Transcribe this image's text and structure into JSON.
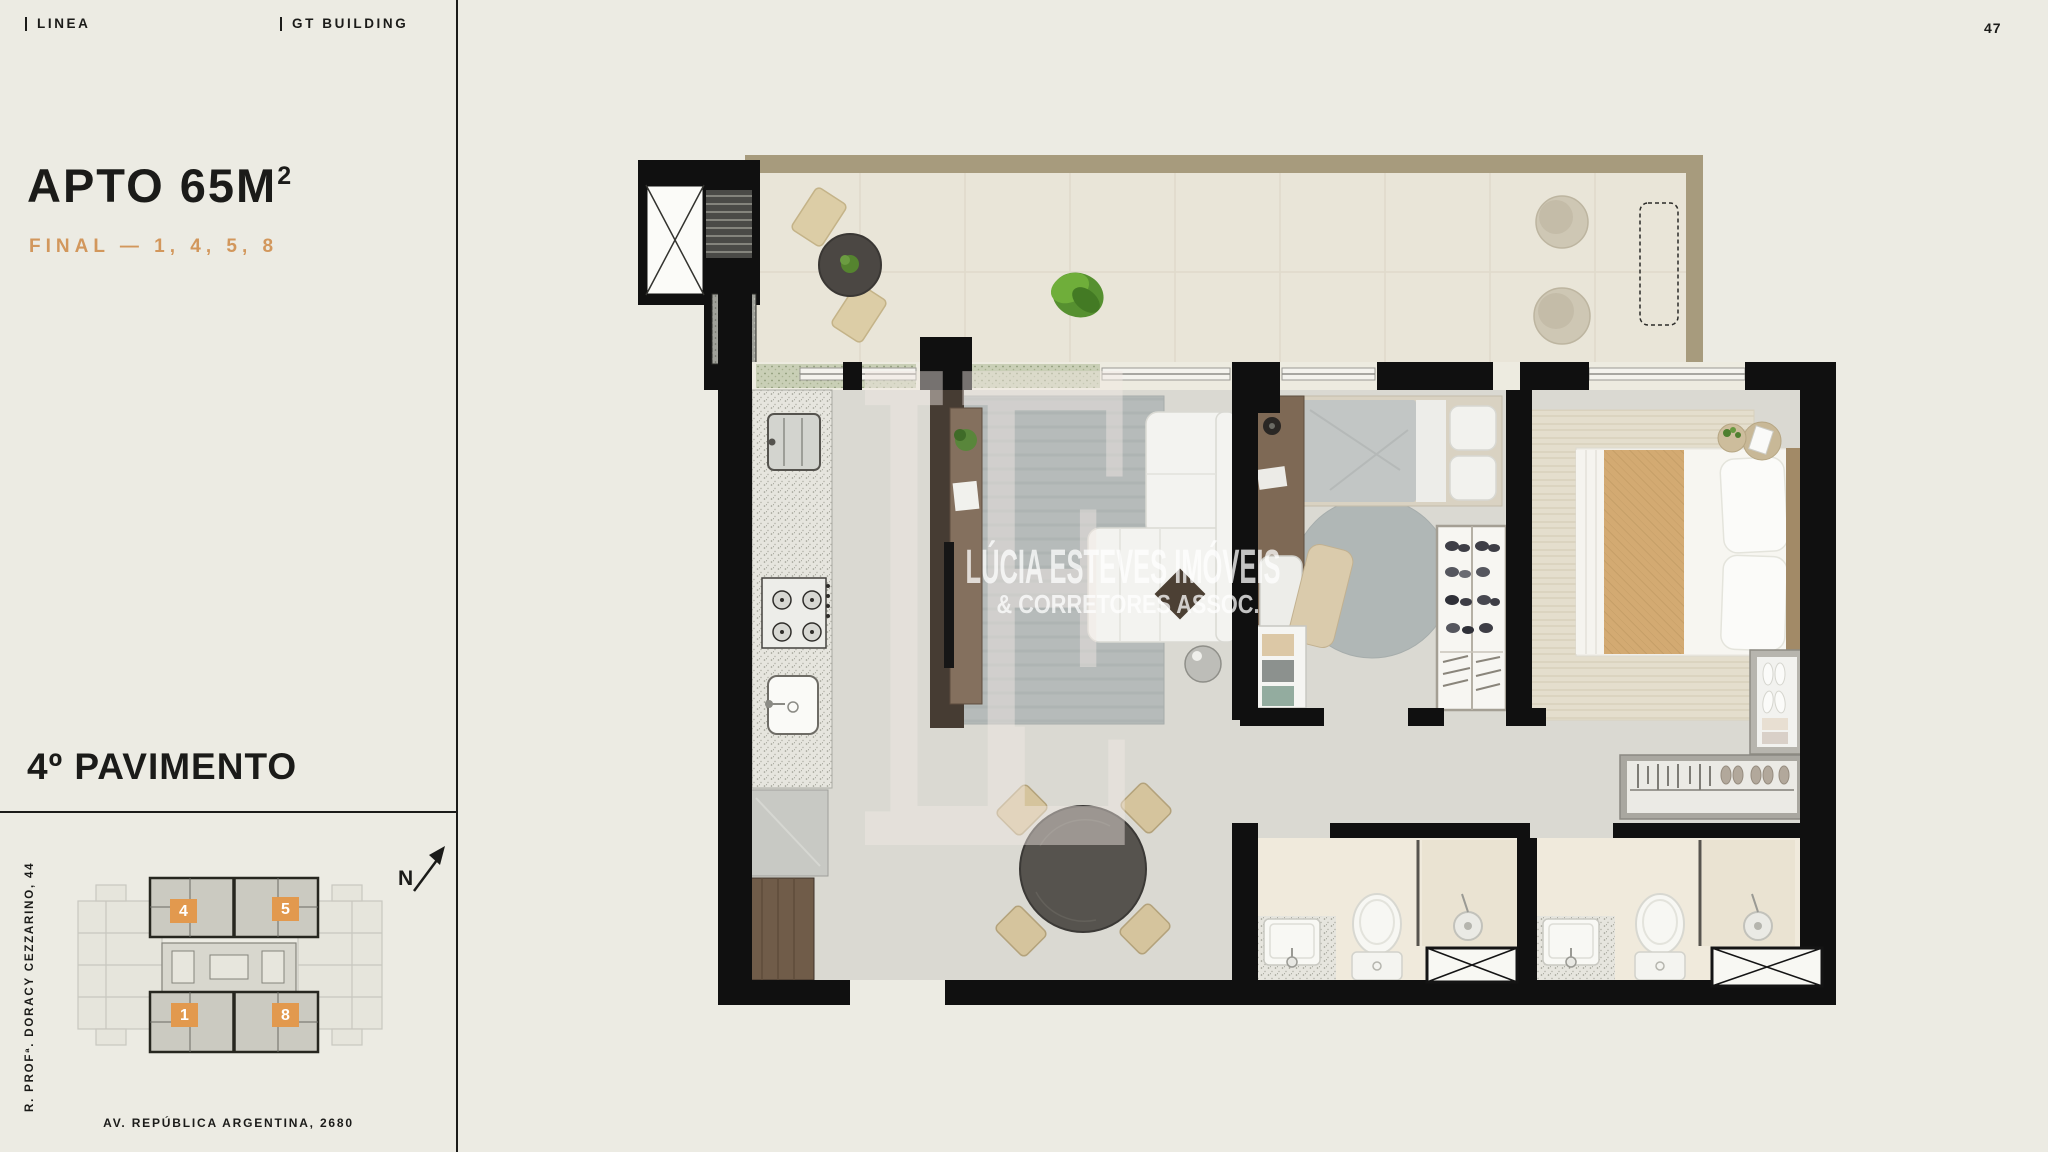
{
  "page": {
    "background": "#ECEBE3",
    "number": "47"
  },
  "header": {
    "brands": [
      {
        "label": "LINEA"
      },
      {
        "label": "GT BUILDING"
      }
    ]
  },
  "sidebar": {
    "title_main": "APTO 65M",
    "title_sup": "2",
    "subtitle": "FINAL — 1, 4, 5, 8",
    "subtitle_color": "#D2975C",
    "floor_label": "4º PAVIMENTO",
    "street_side": "R. PROFª. DORACY CEZZARINO, 44",
    "street_bottom": "AV. REPÚBLICA ARGENTINA, 2680",
    "north_label": "N"
  },
  "floorplate": {
    "unit_color": "#E2994E",
    "units": [
      {
        "label": "4"
      },
      {
        "label": "5"
      },
      {
        "label": "1"
      },
      {
        "label": "8"
      }
    ]
  },
  "floorplan": {
    "watermark_monogram": "LE",
    "watermark_line1": "LÚCIA ESTEVES IMÓVEIS",
    "watermark_line2": "& CORRETORES ASSOC."
  }
}
